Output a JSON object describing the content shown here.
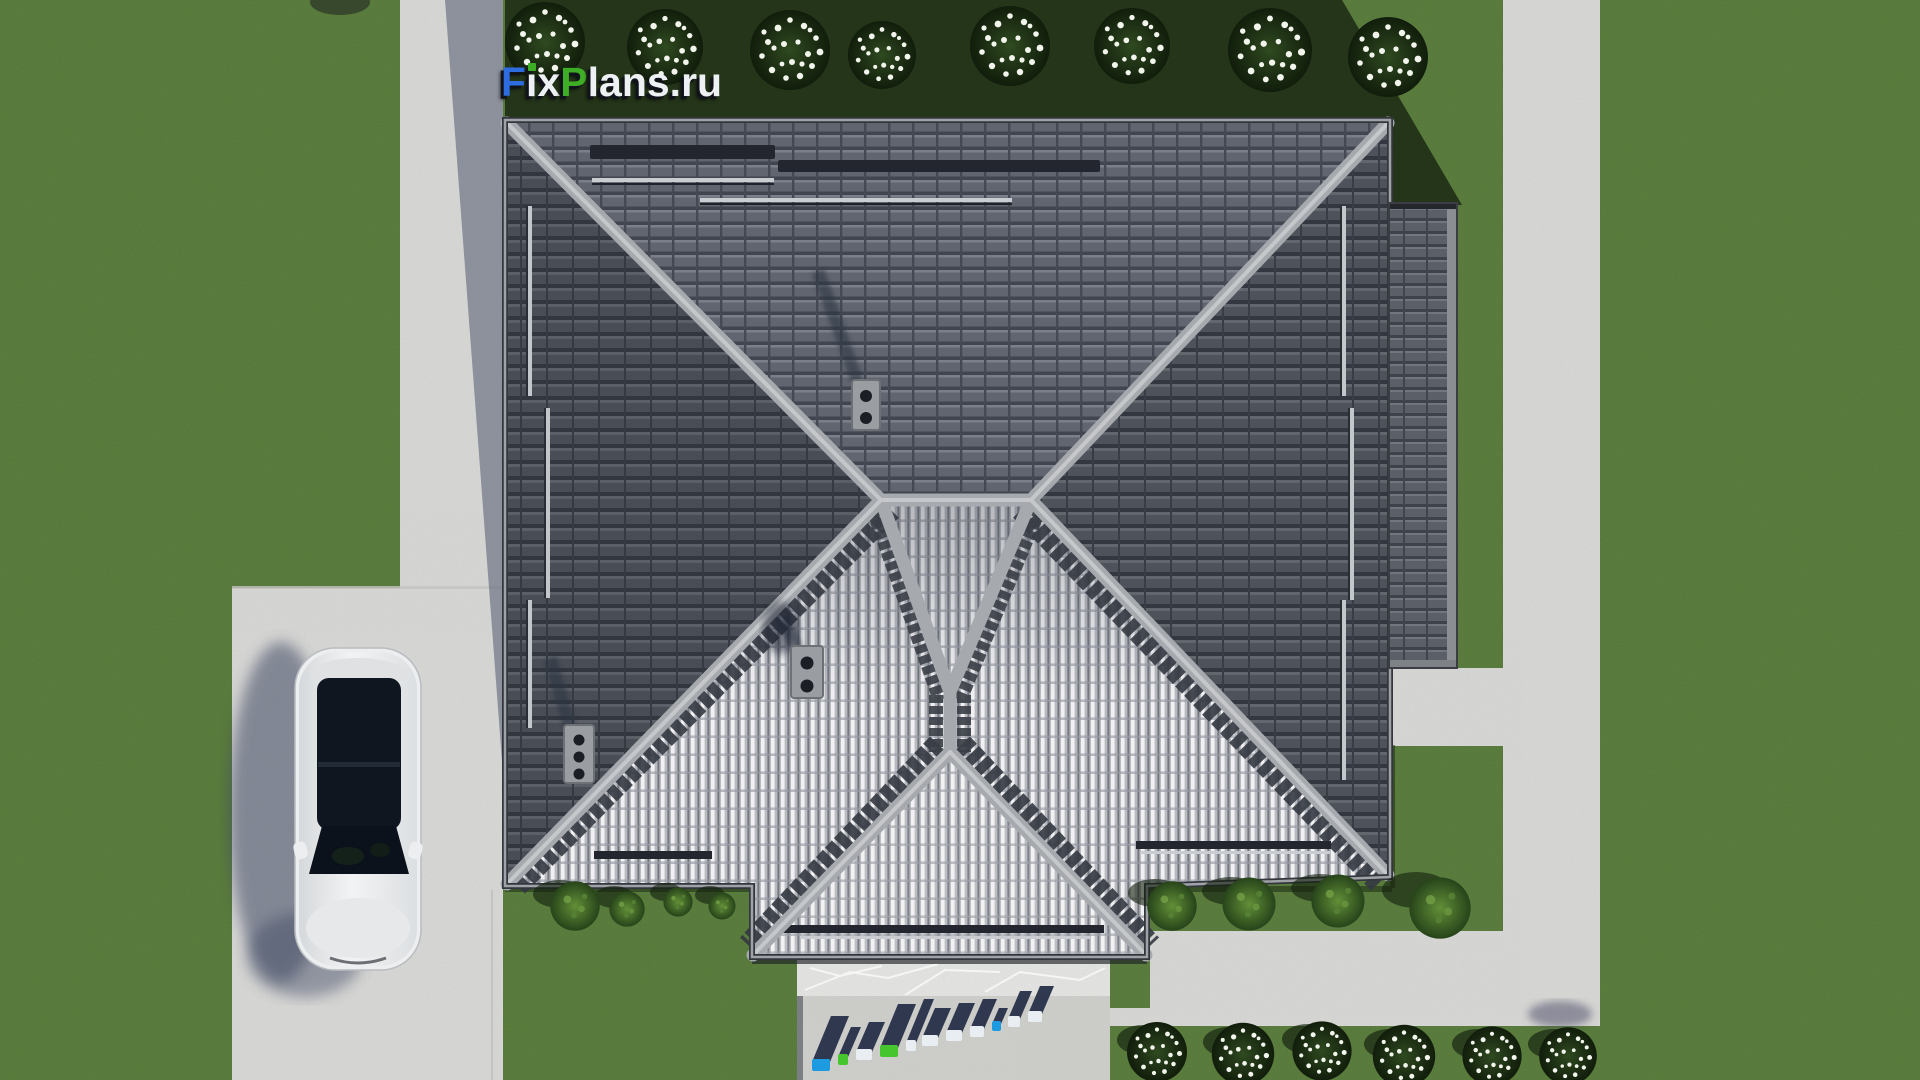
{
  "watermark_top": {
    "full_text": "FixPlans.ru",
    "seg_f": "F",
    "seg_i": "i",
    "seg_x": "x",
    "seg_p": "P",
    "seg_lans": "lans",
    "seg_dot": ".",
    "seg_ru": "ru"
  },
  "watermark_bottom": {
    "text": "FixPlans.ru"
  },
  "colors": {
    "brand_blue": "#2d6de0",
    "brand_green": "#3fae27",
    "logo_white": "#eef1f4",
    "grass": "#567839",
    "grass_shadow": "#1c2b14",
    "concrete": "#d8d8d6",
    "concrete_shadow": "#5b6478",
    "roof_dark": "#565a62",
    "roof_north": "#60646e",
    "roof_bright": "#bfc1c7",
    "ridge": "#a6a9ad",
    "terrace": "#e6e6e4",
    "car_body": "#eceeef",
    "car_glass": "#10161f"
  }
}
